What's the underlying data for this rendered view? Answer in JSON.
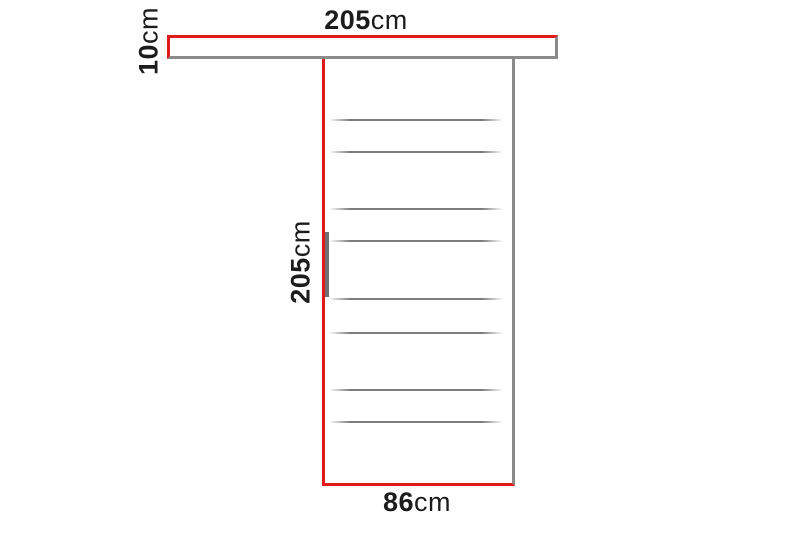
{
  "diagram": {
    "subject": "sliding-door-with-top-rail-dimension-diagram",
    "dimensions": {
      "rail_width": {
        "number": "205",
        "unit": "cm"
      },
      "rail_height": {
        "number": "10",
        "unit": "cm"
      },
      "door_height": {
        "number": "205",
        "unit": "cm"
      },
      "door_width": {
        "number": "86",
        "unit": "cm"
      }
    },
    "door_slat_count": 8,
    "colors": {
      "dimension_red": "#e01a1a",
      "outline_gray": "#8b8b8b",
      "slat_gray": "#7d7d7d",
      "handle_gray": "#6e6e6e",
      "label_black": "#1c1c1c",
      "background": "#ffffff"
    }
  }
}
